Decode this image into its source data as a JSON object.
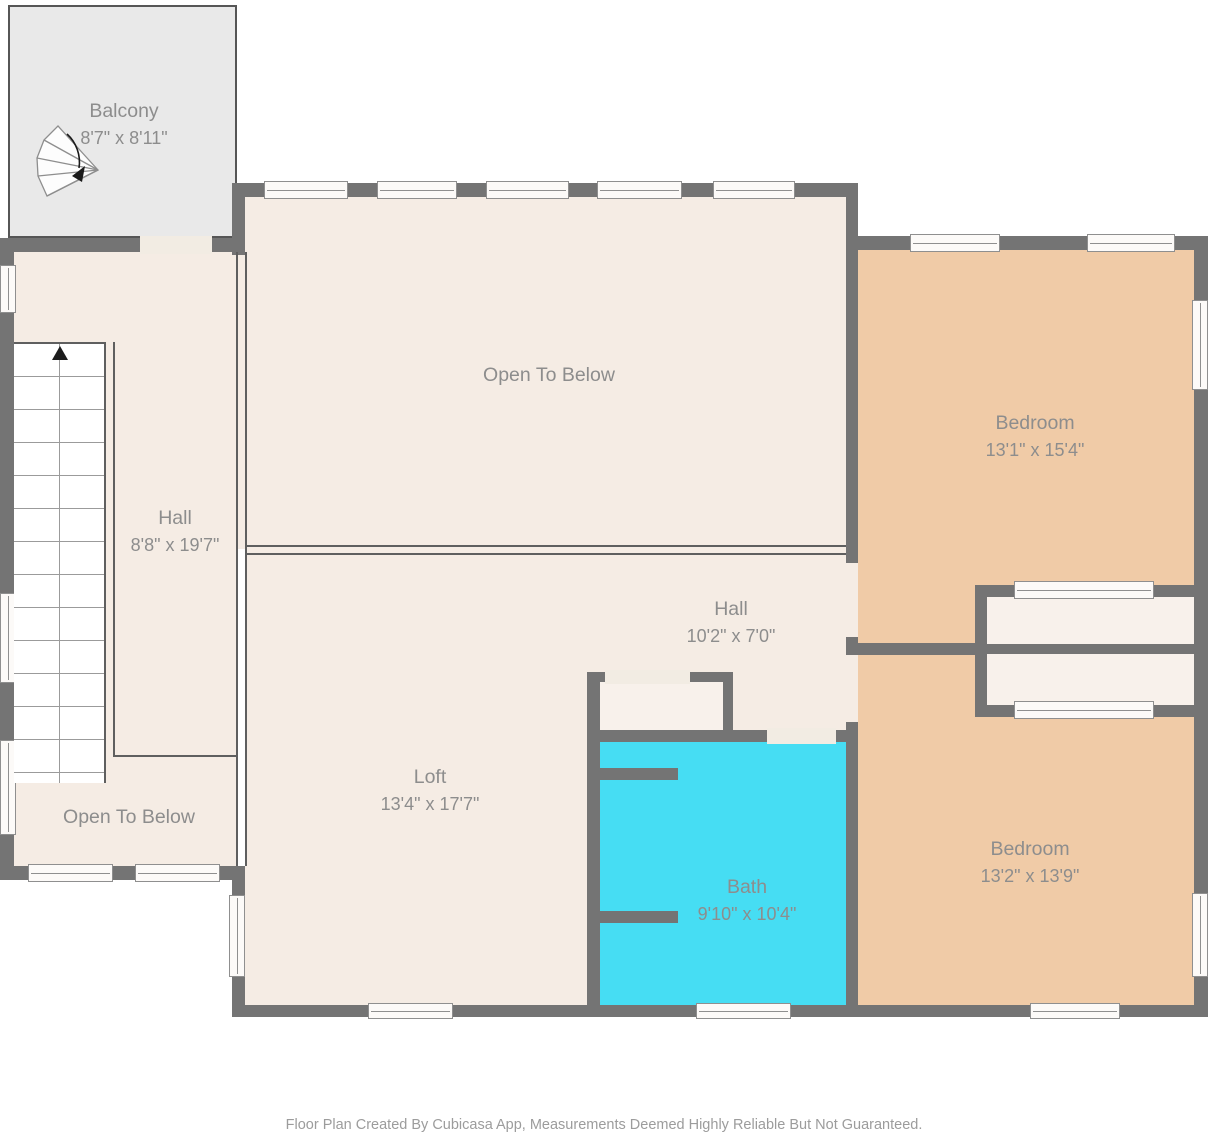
{
  "footer": "Floor Plan Created By Cubicasa App, Measurements Deemed Highly Reliable But Not Guaranteed.",
  "rooms": {
    "balcony": {
      "name": "Balcony",
      "dims": "8'7\" x 8'11\""
    },
    "open_below_top": {
      "name": "Open To Below"
    },
    "bedroom_top": {
      "name": "Bedroom",
      "dims": "13'1\" x 15'4\""
    },
    "hall_left": {
      "name": "Hall",
      "dims": "8'8\" x 19'7\""
    },
    "hall_center": {
      "name": "Hall",
      "dims": "10'2\" x 7'0\""
    },
    "loft": {
      "name": "Loft",
      "dims": "13'4\" x 17'7\""
    },
    "bath": {
      "name": "Bath",
      "dims": "9'10\" x 10'4\""
    },
    "bedroom_bottom": {
      "name": "Bedroom",
      "dims": "13'2\" x 13'9\""
    },
    "open_below_bottom": {
      "name": "Open To Below"
    }
  },
  "icons": {
    "up_arrow": "▲",
    "spiral_stairs": "fan-winder-stairs-with-turn-arrow"
  },
  "colors": {
    "wall": "#747474",
    "floor": "#f5ece4",
    "bedroom_floor": "#f0cba7",
    "bath_floor": "#46ddf3",
    "balcony_floor": "#e9e9e9",
    "closet_floor": "#f8f1eb",
    "door_gap": "#f2ece3",
    "window_fill": "#fcfaf8",
    "window_border": "#8f8f8f",
    "boundary_line": "#5f5f5f",
    "step_line": "#9b9b9b",
    "label_text": "#8d8d8d",
    "footer_text": "#9c9c9c",
    "background": "#ffffff"
  }
}
